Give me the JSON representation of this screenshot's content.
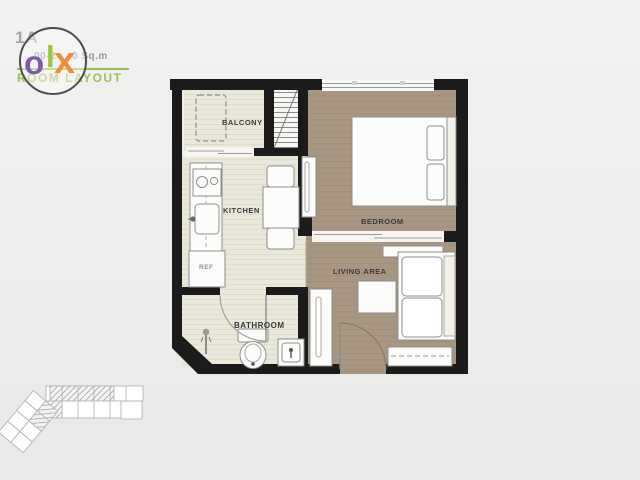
{
  "watermark": {
    "unit_type": "1A",
    "area_fragment_left": "00-2",
    "area_fragment_right": "0 Sq.m",
    "room_layout_label": "ROOM LAYOUT",
    "logo_letters": {
      "first": "o",
      "second": "l",
      "third": "x"
    },
    "logo_colors": {
      "o": "#7b5aa7",
      "l": "#9ec437",
      "x": "#ef8f35"
    },
    "accent_green": "#9dc04a"
  },
  "floorplan": {
    "rooms": {
      "balcony": "BALCONY",
      "kitchen": "KITCHEN",
      "bedroom": "BEDROOM",
      "living_area": "LIVING AREA",
      "bathroom": "BATHROOM"
    },
    "fixtures": {
      "refrigerator": "REF"
    },
    "colors": {
      "wall": "#1b1b1b",
      "wood_floor": "#a79682",
      "tile_floor": "#eae7db",
      "fixture_stroke": "#8e8e8e"
    }
  },
  "keyplan": {
    "highlight_style": "hatched",
    "line_color": "#b5b5b5"
  }
}
